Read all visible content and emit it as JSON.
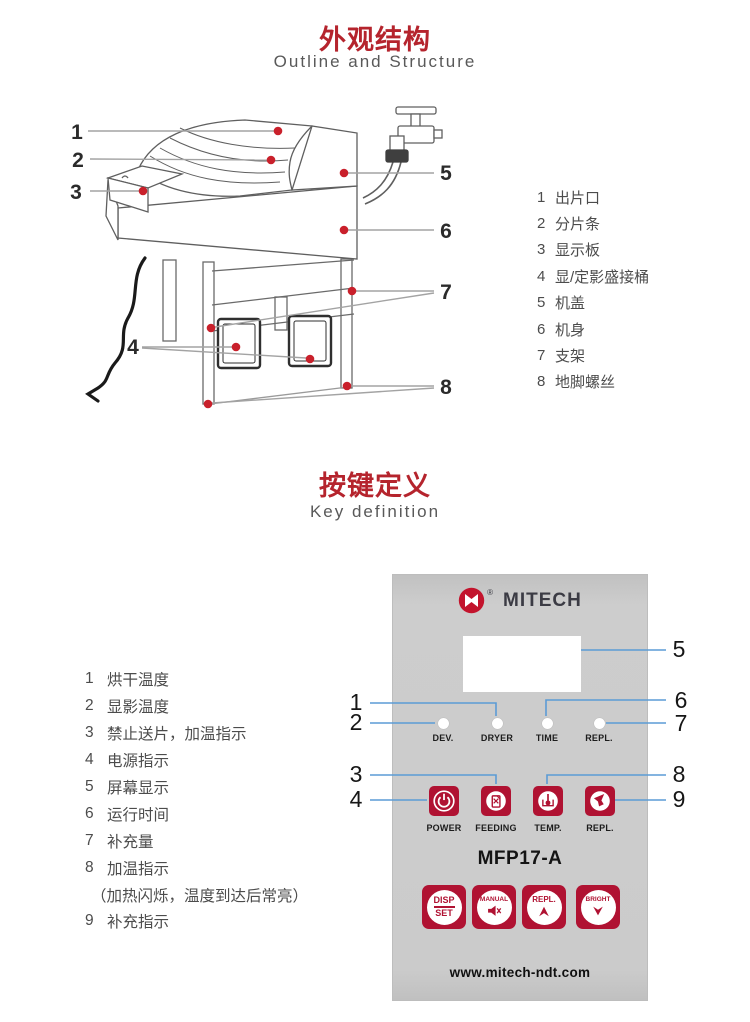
{
  "colors": {
    "title_red": "#b5242d",
    "button_red": "#b01232",
    "logo_red": "#c3142d",
    "callout_dot_red": "#c9202b",
    "panel_line_blue": "#5b9bd5",
    "diagram_line_gray": "#a3a3a3",
    "panel_gray": "#cbcbcb"
  },
  "outline": {
    "title": "外观结构",
    "subtitle": "Outline and Structure",
    "callouts": [
      "1",
      "2",
      "3",
      "4",
      "5",
      "6",
      "7",
      "8"
    ],
    "legend": [
      {
        "num": "1",
        "label": "出片口"
      },
      {
        "num": "2",
        "label": "分片条"
      },
      {
        "num": "3",
        "label": "显示板"
      },
      {
        "num": "4",
        "label": "显/定影盛接桶"
      },
      {
        "num": "5",
        "label": "机盖"
      },
      {
        "num": "6",
        "label": "机身"
      },
      {
        "num": "7",
        "label": "支架"
      },
      {
        "num": "8",
        "label": "地脚螺丝"
      }
    ]
  },
  "keys": {
    "title": "按键定义",
    "subtitle": "Key definition",
    "definitions": [
      {
        "num": "1",
        "label": "烘干温度"
      },
      {
        "num": "2",
        "label": "显影温度"
      },
      {
        "num": "3",
        "label": "禁止送片，加温指示"
      },
      {
        "num": "4",
        "label": "电源指示"
      },
      {
        "num": "5",
        "label": "屏幕显示"
      },
      {
        "num": "6",
        "label": "运行时间"
      },
      {
        "num": "7",
        "label": "补充量"
      },
      {
        "num": "8",
        "label": "加温指示"
      },
      {
        "num": "",
        "label": "（加热闪烁，温度到达后常亮）"
      },
      {
        "num": "9",
        "label": "补充指示"
      }
    ],
    "callouts_left": [
      "1",
      "2",
      "3",
      "4"
    ],
    "callouts_right": [
      "5",
      "6",
      "7",
      "8",
      "9"
    ]
  },
  "panel": {
    "brand": "MITECH",
    "registered_mark": "®",
    "model": "MFP17-A",
    "website": "www.mitech-ndt.com",
    "indicators": [
      {
        "label": "DEV."
      },
      {
        "label": "DRYER"
      },
      {
        "label": "TIME"
      },
      {
        "label": "REPL."
      }
    ],
    "buttons": [
      {
        "label": "POWER",
        "icon": "power-icon"
      },
      {
        "label": "FEEDING",
        "icon": "feeding-icon"
      },
      {
        "label": "TEMP.",
        "icon": "temperature-icon"
      },
      {
        "label": "REPL.",
        "icon": "replenish-icon"
      }
    ],
    "function_buttons": [
      {
        "line1": "DISP",
        "line2": "SET"
      },
      {
        "line1": "MANUAL",
        "icon": "speaker-mute-icon"
      },
      {
        "line1": "REPL.",
        "icon": "up-arrow-icon"
      },
      {
        "line1": "BRIGHT",
        "icon": "down-arrow-icon"
      }
    ]
  }
}
